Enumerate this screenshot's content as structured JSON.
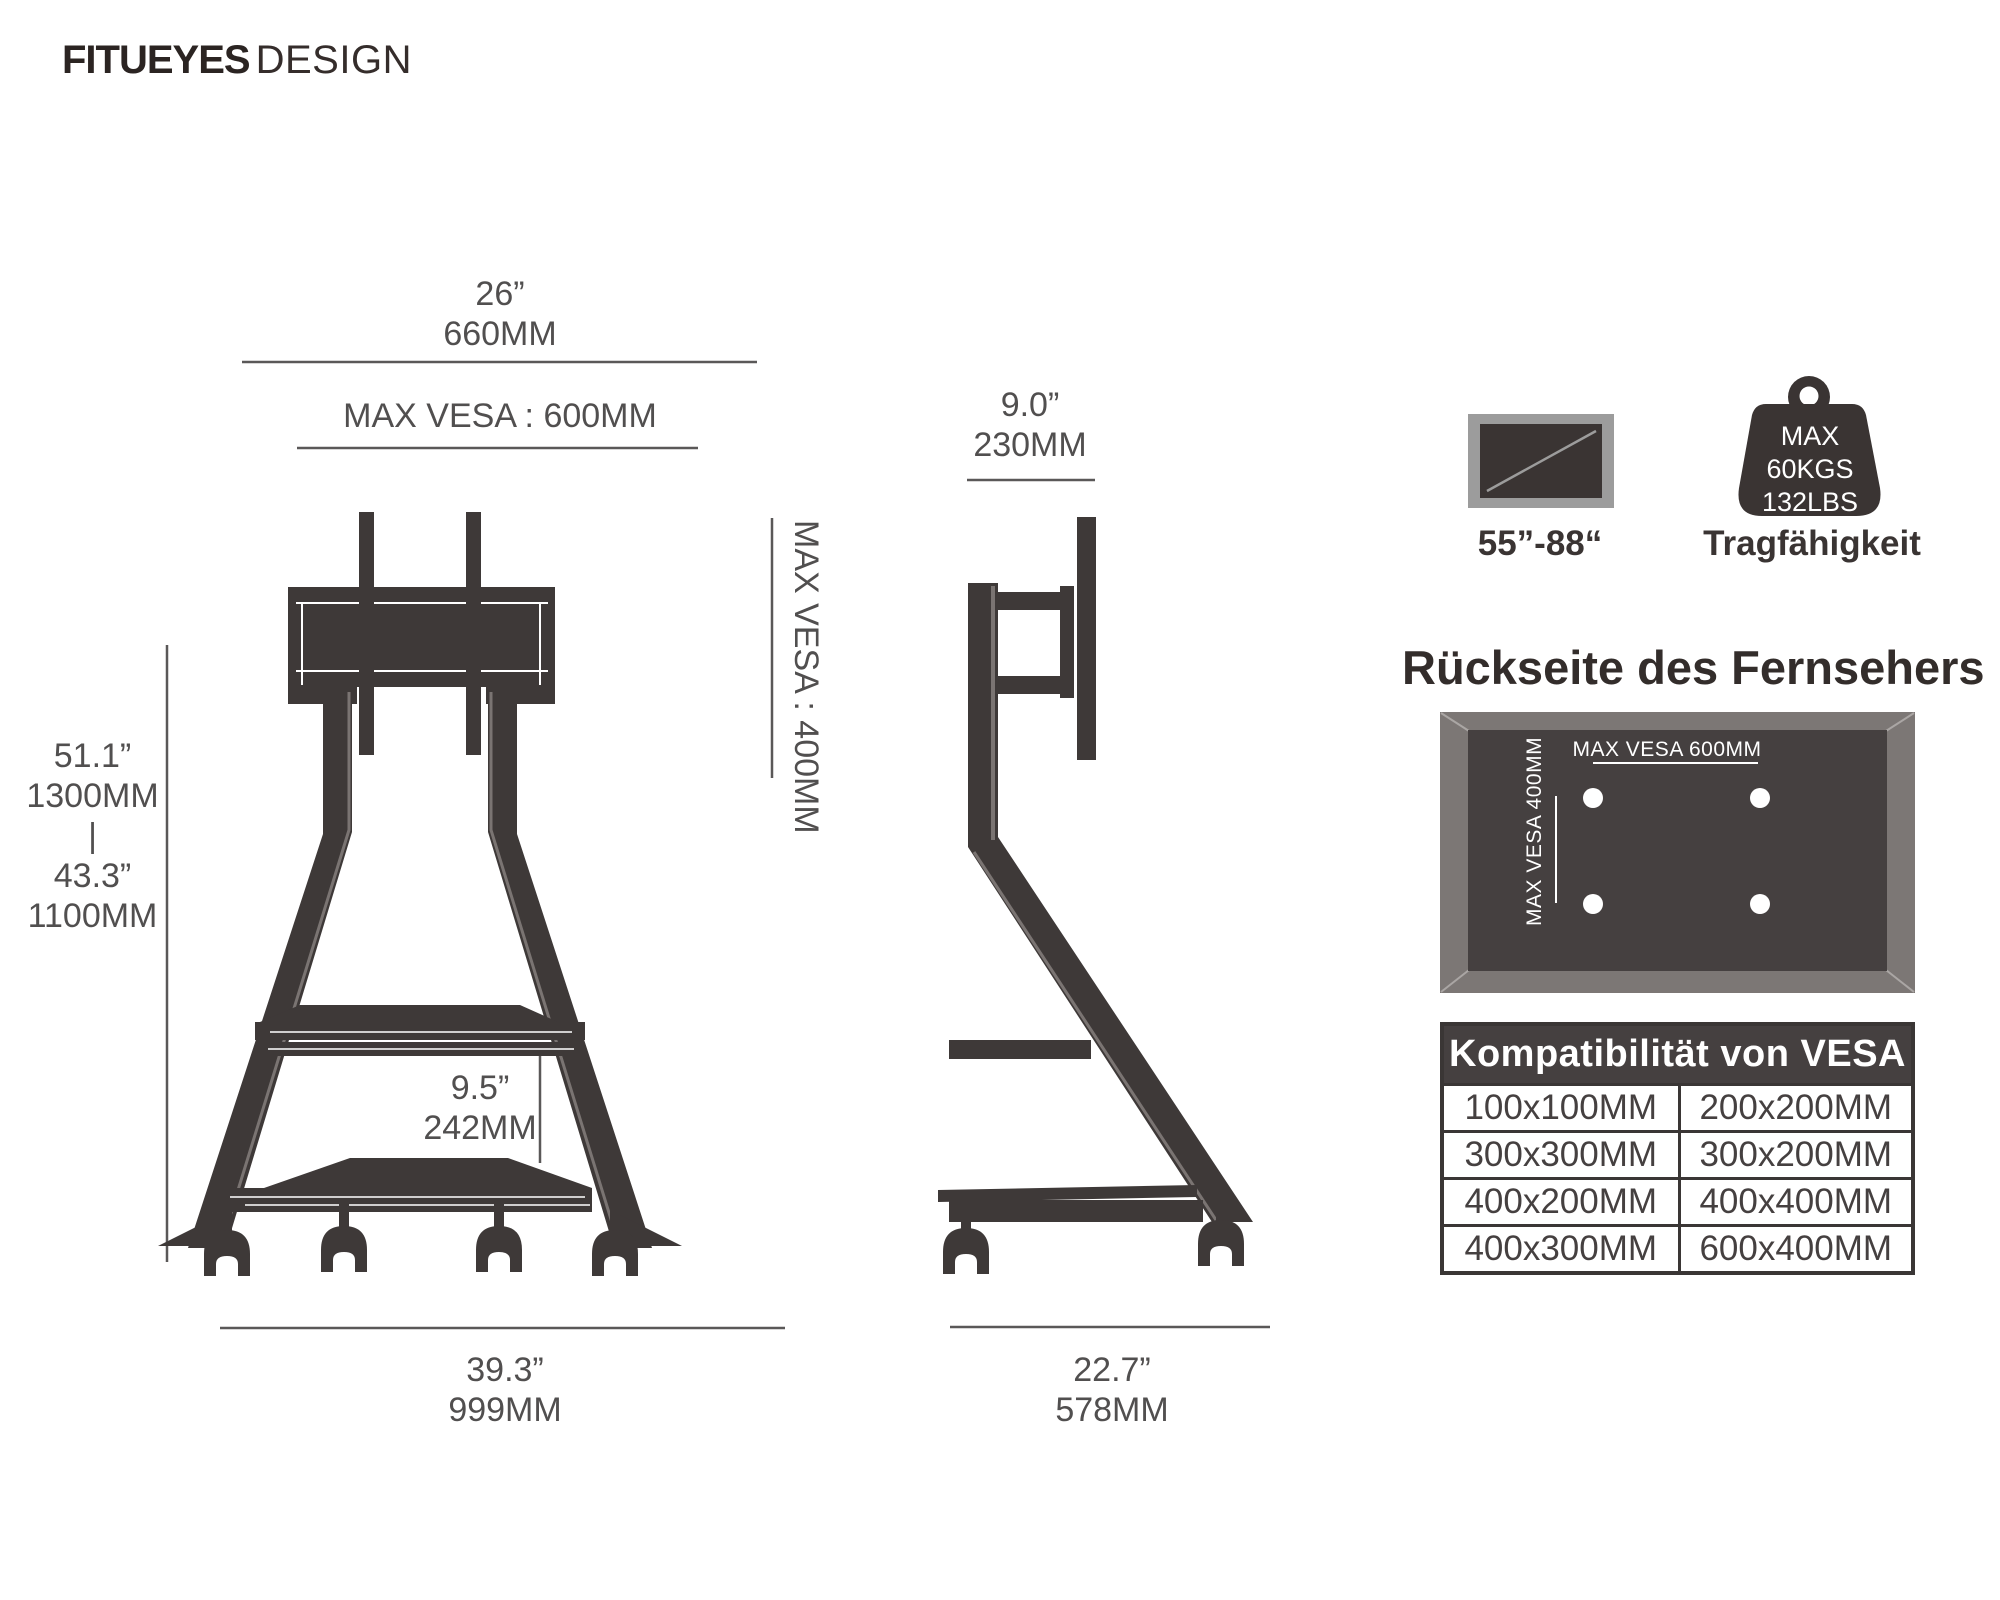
{
  "brand": {
    "bold": "FITUEYES",
    "light": "DESIGN"
  },
  "front_view": {
    "top_width_in": "26”",
    "top_width_mm": "660MM",
    "max_vesa_width": "MAX VESA :  600MM",
    "h1_in": "51.1”",
    "h1_mm": "1300MM",
    "sep": "|",
    "h2_in": "43.3”",
    "h2_mm": "1100MM",
    "max_vesa_height": "MAX VESA :  400MM",
    "gap_in": "9.5”",
    "gap_mm": "242MM",
    "base_in": "39.3”",
    "base_mm": "999MM"
  },
  "side_view": {
    "depth_in": "9.0”",
    "depth_mm": "230MM",
    "base_in": "22.7”",
    "base_mm": "578MM"
  },
  "badges": {
    "tv_range": "55”-88“",
    "cap1": "MAX",
    "cap2": "60KGS",
    "cap3": "132LBS",
    "capacity_label": "Tragfähigkeit"
  },
  "tv_back": {
    "title": "Rückseite des Fernsehers",
    "h_label": "MAX VESA 600MM",
    "v_label": "MAX VESA 400MM"
  },
  "table": {
    "title": "Kompatibilität von VESA",
    "rows": [
      [
        "100x100MM",
        "200x200MM"
      ],
      [
        "300x300MM",
        "300x200MM"
      ],
      [
        "400x200MM",
        "400x400MM"
      ],
      [
        "400x300MM",
        "600x400MM"
      ]
    ]
  },
  "colors": {
    "ink": "#3e3938",
    "dim_line": "#5a5858",
    "panel_frame": "#7c7775",
    "panel_inner": "#454040",
    "icon_gray": "#9c9c9c"
  }
}
